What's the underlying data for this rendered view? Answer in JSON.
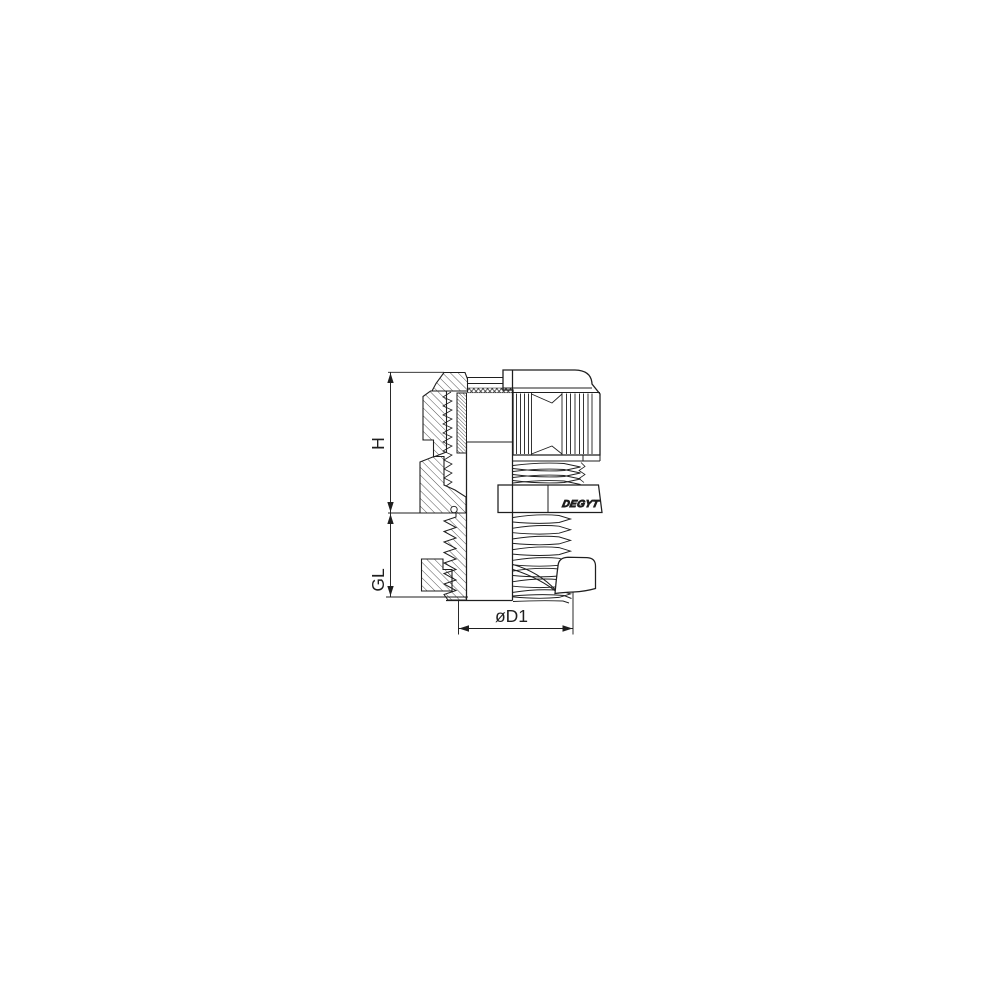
{
  "page": {
    "background_color": "#ffffff",
    "line_color": "#1f1f1f"
  },
  "drawing": {
    "type": "technical-line-drawing",
    "subject": "cable gland half cross-section with knurled cap nut, seal insert, hex body and mounting thread",
    "dimension_labels": {
      "h": "H",
      "gl": "GL",
      "d1": "øD1"
    },
    "logo_text": "DEGYT"
  }
}
